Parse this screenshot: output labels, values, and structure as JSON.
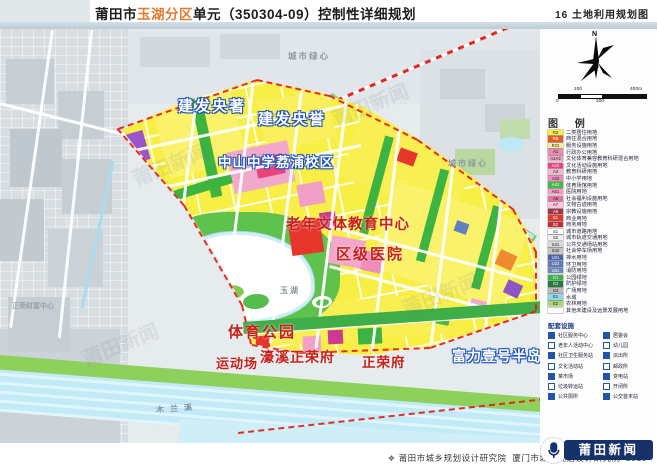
{
  "header": {
    "title_prefix": "莆田市",
    "title_highlight": "玉湖分区",
    "title_suffix": "单元（350304-09）控制性详细规划",
    "sheet_no": "16",
    "sheet_name": "土地利用规划图"
  },
  "legend": {
    "north_label": "N",
    "scale_labels": {
      "top_left": "100",
      "top_right": "400m",
      "bottom_left": "0",
      "bottom_mid": "200"
    },
    "title": "图 例",
    "items": [
      {
        "code": "R2",
        "label": "二类居住用地",
        "color": "#f7f03a"
      },
      {
        "code": "RB",
        "label": "商住混合用地",
        "color": "#e85a28"
      },
      {
        "code": "R22",
        "label": "服务设施用地",
        "color": "#f9f09a"
      },
      {
        "code": "A1",
        "label": "行政办公用地",
        "color": "#ef86b4"
      },
      {
        "code": "A2A3",
        "label": "文化体育兼容教育科研混合用地",
        "color": "#f2a6c8"
      },
      {
        "code": "A22",
        "label": "文化活动设施用地",
        "color": "#e8457f"
      },
      {
        "code": "A3",
        "label": "教育科研用地",
        "color": "#f4b6d2"
      },
      {
        "code": "A33",
        "label": "中小学用地",
        "color": "#ee8cba"
      },
      {
        "code": "A41",
        "label": "体育场馆用地",
        "color": "#46b946"
      },
      {
        "code": "A51",
        "label": "医院用地",
        "color": "#f29ec2"
      },
      {
        "code": "A6",
        "label": "社会福利设施用地",
        "color": "#ec6fa4"
      },
      {
        "code": "A7",
        "label": "文物古迹用地",
        "color": "#f6c8da"
      },
      {
        "code": "A9",
        "label": "宗教设施用地",
        "color": "#a83246"
      },
      {
        "code": "B1",
        "label": "商业用地",
        "color": "#e6352a"
      },
      {
        "code": "B2",
        "label": "商务用地",
        "color": "#c22c34"
      },
      {
        "code": "S1",
        "label": "城市道路用地",
        "color": "#ffffff"
      },
      {
        "code": "S2",
        "label": "城市轨道交通用地",
        "color": "#eeeeee"
      },
      {
        "code": "S41",
        "label": "公共交通场站用地",
        "color": "#d8d8d8"
      },
      {
        "code": "S42",
        "label": "社会停车场用地",
        "color": "#c4c4c4"
      },
      {
        "code": "U21",
        "label": "排水用地",
        "color": "#4a66aa"
      },
      {
        "code": "U22",
        "label": "环卫用地",
        "color": "#5f7ab8"
      },
      {
        "code": "U31",
        "label": "消防用地",
        "color": "#7088c0"
      },
      {
        "code": "G1",
        "label": "公园绿地",
        "color": "#3cb24a"
      },
      {
        "code": "G2",
        "label": "防护绿地",
        "color": "#207c38"
      },
      {
        "code": "G3",
        "label": "广场用地",
        "color": "#bcbcbc"
      },
      {
        "code": "E1",
        "label": "水域",
        "color": "#8fd8ea"
      },
      {
        "code": "E2",
        "label": "农林用地",
        "color": "#a8d86a"
      },
      {
        "code": "",
        "label": "其他未建设及远景发展用地",
        "color": "#ffffff"
      }
    ],
    "facilities": {
      "title": "配套设施",
      "items_left": [
        "社区服务中心",
        "老年人活动中心",
        "社区卫生服务站",
        "文化活动站",
        "菜市场",
        "垃圾转运站",
        "公共厕所"
      ],
      "items_right": [
        "居委会",
        "幼儿园",
        "派出所",
        "邮政所",
        "变电站",
        "开闭所",
        "公交首末站"
      ]
    }
  },
  "map": {
    "labels": {
      "jianfa_yangzhu": "建发央著",
      "jianfa_yangyu": "建发央誉",
      "school": "中山中学荔浦校区",
      "elderly_center": "老年文体教育中心",
      "hospital": "区级医院",
      "sports_park": "体育公园",
      "sports_field": "运动场",
      "haoxi_zhengrongfu": "濠溪正荣府",
      "zhengrongfu": "正荣府",
      "fuli_peninsula": "富力壹号半岛",
      "green_heart": "城市绿心",
      "lake": "玉湖",
      "mulan_river": "木兰溪",
      "zhengrong_wealth_center": "正荣财富中心"
    },
    "watermark": "莆田新闻",
    "colors": {
      "boundary_red": "#ea1c14",
      "water_blue": "#c2ebf7",
      "residential_yellow": "#f7ef45",
      "accent_orange": "#e07a2e"
    }
  },
  "footer": {
    "institute1": "莆田市城乡规划设计研究院",
    "institute2": "厦门市城市规划设计研究院",
    "year": "2019"
  },
  "logo": {
    "name": "莆田新闻"
  }
}
